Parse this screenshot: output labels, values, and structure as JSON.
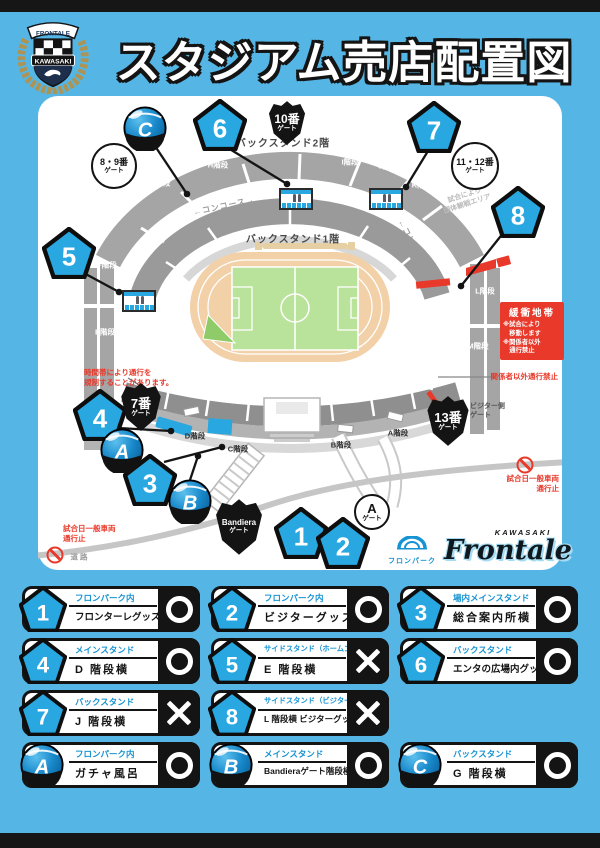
{
  "colors": {
    "bg": "#55b6e6",
    "accent": "#29a7e0",
    "accent_text": "#1693d2",
    "red": "#e8392b",
    "dark": "#161616",
    "pitch": "#b9e29b",
    "track": "#f2d0a8"
  },
  "header": {
    "title": "スタジアム売店配置図",
    "crest": {
      "ribbon": "FRONTALE",
      "banner": "KAWASAKI"
    }
  },
  "map": {
    "section_labels": [
      {
        "text": "バックスタンド2階",
        "x": 245,
        "y": 46
      },
      {
        "text": "バックスタンド1階",
        "x": 255,
        "y": 142
      }
    ],
    "stairs": [
      {
        "text": "G階段",
        "x": 122,
        "y": 87,
        "dark": false
      },
      {
        "text": "H階段",
        "x": 180,
        "y": 69,
        "dark": false
      },
      {
        "text": "I階段",
        "x": 312,
        "y": 66,
        "dark": false
      },
      {
        "text": "J階段",
        "x": 350,
        "y": 70,
        "dark": false
      },
      {
        "text": "K階段",
        "x": 384,
        "y": 89,
        "dark": false
      },
      {
        "text": "F階段",
        "x": 69,
        "y": 169,
        "dark": false
      },
      {
        "text": "E階段",
        "x": 67,
        "y": 236,
        "dark": false
      },
      {
        "text": "L階段",
        "x": 447,
        "y": 195,
        "dark": false
      },
      {
        "text": "M階段",
        "x": 440,
        "y": 250,
        "dark": false
      },
      {
        "text": "D階段",
        "x": 157,
        "y": 340,
        "dark": true
      },
      {
        "text": "C階段",
        "x": 200,
        "y": 353,
        "dark": true
      },
      {
        "text": "B階段",
        "x": 303,
        "y": 349,
        "dark": true
      },
      {
        "text": "A階段",
        "x": 360,
        "y": 337,
        "dark": true
      }
    ],
    "concourse": [
      {
        "text": "←コンコース→",
        "x": 186,
        "y": 110,
        "rot": -12
      },
      {
        "text": "←コンコース→",
        "x": 377,
        "y": 152,
        "rot": 62
      }
    ],
    "faint_note": {
      "lines": [
        "試合により",
        "団体観戦エリア"
      ],
      "x": 428,
      "y": 104,
      "rot": -18
    },
    "visitor_gate": {
      "lines": [
        "ビジター側",
        "ゲート"
      ],
      "x": 432,
      "y": 306
    },
    "badges": [
      {
        "id": "1",
        "type": "pentagon",
        "x": 263,
        "y": 437
      },
      {
        "id": "2",
        "type": "pentagon",
        "x": 305,
        "y": 447
      },
      {
        "id": "3",
        "type": "pentagon",
        "x": 112,
        "y": 384
      },
      {
        "id": "4",
        "type": "pentagon",
        "x": 62,
        "y": 319
      },
      {
        "id": "5",
        "type": "pentagon",
        "x": 31,
        "y": 157
      },
      {
        "id": "6",
        "type": "pentagon",
        "x": 182,
        "y": 29
      },
      {
        "id": "7",
        "type": "pentagon",
        "x": 396,
        "y": 31
      },
      {
        "id": "8",
        "type": "pentagon",
        "x": 480,
        "y": 116
      },
      {
        "id": "A",
        "type": "ball",
        "x": 84,
        "y": 354
      },
      {
        "id": "B",
        "type": "ball",
        "x": 152,
        "y": 405
      },
      {
        "id": "C",
        "type": "ball",
        "x": 107,
        "y": 32
      }
    ],
    "gates": [
      {
        "shape": "shield",
        "lines": [
          "10番",
          "ゲート"
        ],
        "x": 249,
        "y": 27,
        "w": 38,
        "h": 46,
        "big": 12
      },
      {
        "shape": "shield",
        "lines": [
          "7番",
          "ゲート"
        ],
        "x": 103,
        "y": 311,
        "w": 42,
        "h": 50,
        "big": 13
      },
      {
        "shape": "shield",
        "lines": [
          "13番",
          "ゲート"
        ],
        "x": 410,
        "y": 325,
        "w": 44,
        "h": 52,
        "big": 13
      },
      {
        "shape": "shield",
        "lines": [
          "Bandiera",
          "ゲート"
        ],
        "x": 201,
        "y": 431,
        "w": 50,
        "h": 58,
        "big": 8
      },
      {
        "shape": "circle",
        "lines": [
          "8・9番",
          "ゲート"
        ],
        "x": 76,
        "y": 70,
        "d": 42,
        "big": 9
      },
      {
        "shape": "circle",
        "lines": [
          "11・12番",
          "ゲート"
        ],
        "x": 437,
        "y": 70,
        "d": 44,
        "big": 9
      },
      {
        "shape": "circle",
        "lines": [
          "A",
          "ゲート"
        ],
        "x": 334,
        "y": 416,
        "d": 32,
        "big": 13
      }
    ],
    "kiosks": [
      {
        "x": 241,
        "y": 92
      },
      {
        "x": 331,
        "y": 92
      },
      {
        "x": 84,
        "y": 194
      }
    ],
    "buffer_box": {
      "title": "緩衝地帯",
      "lines": [
        "※試合により",
        "　移動します",
        "※関係者以外",
        "　通行禁止"
      ],
      "x": 462,
      "y": 206
    },
    "red_notes": [
      {
        "lines": [
          "時間帯により通行を",
          "規制することがあります。"
        ],
        "x": 46,
        "y": 272,
        "align": "left"
      },
      {
        "lines": [
          "関係者以外通行禁止"
        ],
        "x": 520,
        "y": 276,
        "align": "right"
      },
      {
        "lines": [
          "試合日一般車両",
          "通行止"
        ],
        "x": 521,
        "y": 378,
        "align": "right",
        "icon": {
          "x": 487,
          "y": 369
        }
      },
      {
        "lines": [
          "試合日一般車両",
          "通行止"
        ],
        "x": 25,
        "y": 428,
        "align": "left",
        "icon": {
          "x": 17,
          "y": 459
        }
      }
    ],
    "road_label": {
      "text": "道路",
      "x": 42,
      "y": 461
    },
    "fronpark": {
      "text": "フロンパーク",
      "x": 374,
      "y": 440
    },
    "frontale": {
      "kawasaki": "KAWASAKI",
      "name": "Frontale",
      "x": 470,
      "y": 432
    }
  },
  "legend": {
    "items": [
      {
        "id": "1",
        "type": "pentagon",
        "category": "フロンパーク内",
        "name": "フロンターレグッズ売店",
        "status": "O"
      },
      {
        "id": "2",
        "type": "pentagon",
        "category": "フロンパーク内",
        "name": "ビジターグッズ売店",
        "status": "O"
      },
      {
        "id": "3",
        "type": "pentagon",
        "category": "場内メインスタンド",
        "name": "総合案内所横",
        "status": "O"
      },
      {
        "id": "4",
        "type": "pentagon",
        "category": "メインスタンド",
        "name": "D 階段横",
        "status": "O"
      },
      {
        "id": "5",
        "type": "pentagon",
        "category": "サイドスタンド（ホームゴール裏）",
        "name": "E 階段横",
        "status": "X"
      },
      {
        "id": "6",
        "type": "pentagon",
        "category": "バックスタンド",
        "name": "エンタの広場内グッズ売店",
        "status": "O"
      },
      {
        "id": "7",
        "type": "pentagon",
        "category": "バックスタンド",
        "name": "J 階段横",
        "status": "X"
      },
      {
        "id": "8",
        "type": "pentagon",
        "category": "サイドスタンド（ビジターゴール裏）",
        "name": "L 階段横 ビジターグッズ売店",
        "status": "X"
      },
      {
        "id": "A",
        "type": "ball",
        "category": "フロンパーク内",
        "name": "ガチャ風呂",
        "status": "O"
      },
      {
        "id": "B",
        "type": "ball",
        "category": "メインスタンド",
        "name": "Bandieraゲート階段横",
        "status": "O"
      },
      {
        "id": "C",
        "type": "ball",
        "category": "バックスタンド",
        "name": "G 階段横",
        "status": "O"
      }
    ]
  }
}
